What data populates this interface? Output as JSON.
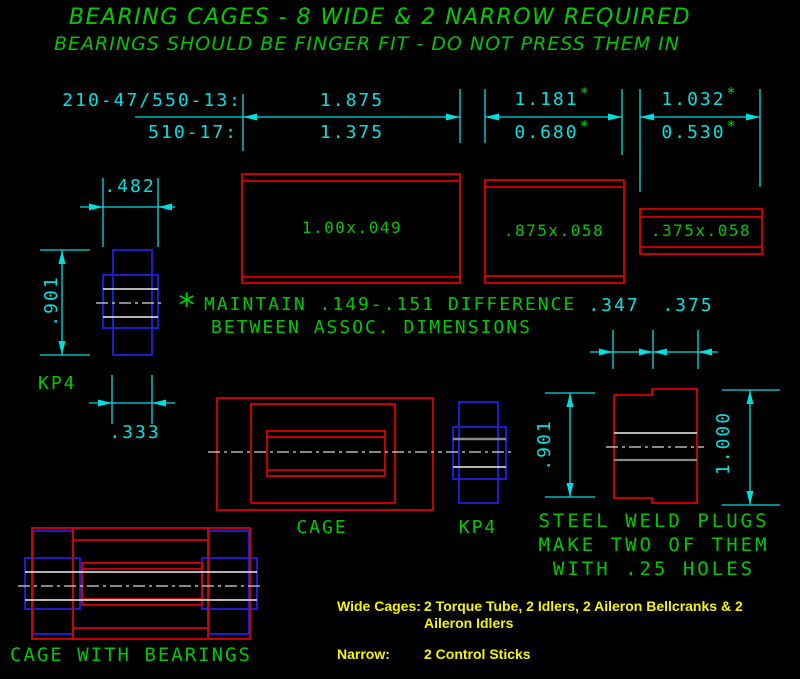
{
  "title": {
    "line1": "BEARING CAGES - 8 WIDE & 2 NARROW REQUIRED",
    "line2": "BEARINGS SHOULD BE FINGER FIT - DO NOT PRESS THEM IN"
  },
  "dims": {
    "row_labels": {
      "top": "210-47/550-13:",
      "bottom": "510-17:"
    },
    "col1": {
      "top": "1.875",
      "bottom": "1.375"
    },
    "col2": {
      "top": "1.181",
      "bottom": "0.680"
    },
    "col3": {
      "top": "1.032",
      "bottom": "0.530"
    },
    "star": "*"
  },
  "tubes": {
    "large": "1.00x.049",
    "medium": ".875x.058",
    "small": ".375x.058"
  },
  "note": {
    "star": "*",
    "line1": "MAINTAIN .149-.151 DIFFERENCE",
    "line2": "BETWEEN ASSOC. DIMENSIONS"
  },
  "kp4_left": {
    "width": ".482",
    "height": ".901",
    "label": "KP4",
    "bore": ".333"
  },
  "cage": {
    "label": "CAGE"
  },
  "kp4_mid": {
    "label": "KP4"
  },
  "plug": {
    "dim_347": ".347",
    "dim_375": ".375",
    "height_left": ".901",
    "height_right": "1.000",
    "caption1": "STEEL WELD PLUGS",
    "caption2": "MAKE TWO OF THEM",
    "caption3": "WITH .25 HOLES"
  },
  "assembly": {
    "label": "CAGE WITH BEARINGS"
  },
  "legend": {
    "wide_label": "Wide Cages:",
    "wide_line1": "2 Torque Tube, 2 Idlers, 2 Aileron Bellcranks & 2",
    "wide_line2": "Aileron Idlers",
    "narrow_label": "Narrow:",
    "narrow_value": "2 Control Sticks"
  },
  "colors": {
    "background": "#000000",
    "dimension_cyan": "#00e2e2",
    "annotation_green": "#00c800",
    "part_red": "#dc0000",
    "bearing_blue": "#2020e0",
    "legend_yellow": "#f5f500",
    "centerline_white": "#d8d8d8",
    "hidden_gray": "#8a8a8a"
  }
}
